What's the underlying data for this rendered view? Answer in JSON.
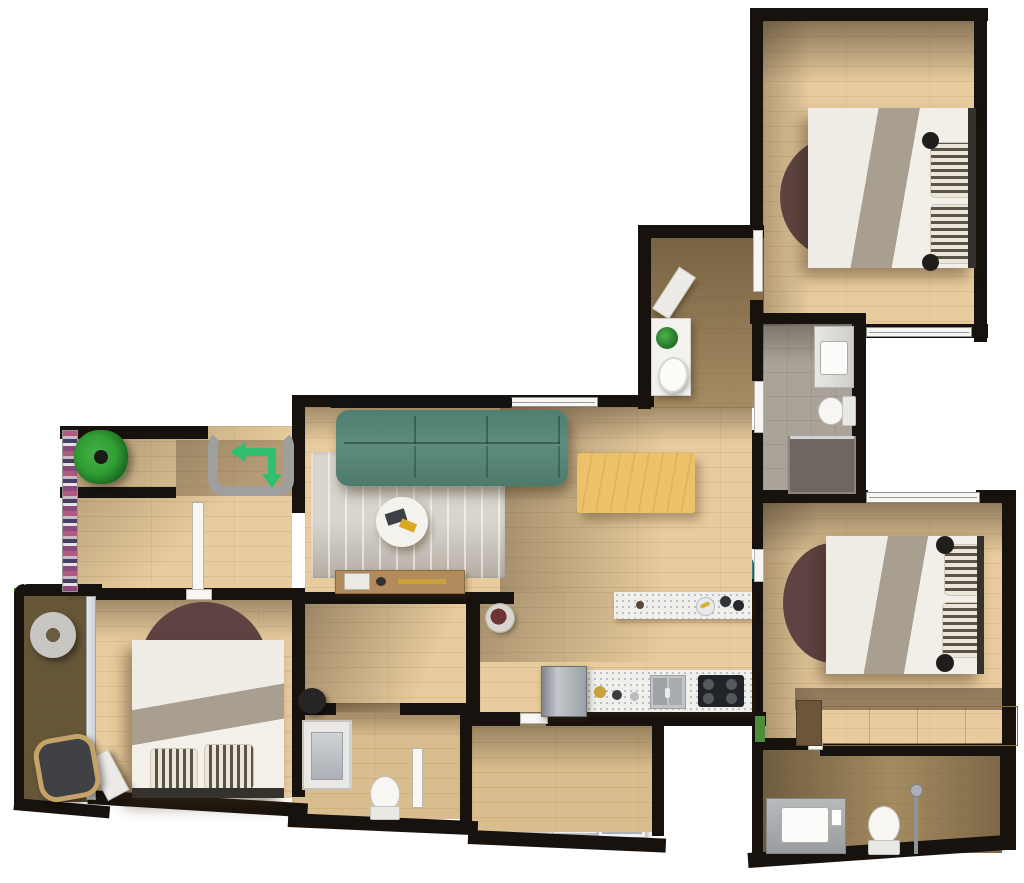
{
  "meta": {
    "title": "3D apartment floor plan — top-down render",
    "view": "top-down",
    "visible_text": "none"
  },
  "palette": {
    "wall": "#17120d",
    "wood": "#e8cc9e",
    "wood_mid": "#d9bd8e",
    "wood_dark": "#b59a6d",
    "balcony_wood": "#9c855c",
    "tile": "#aaa39a",
    "sofa": "#5d8c7e",
    "stool": "#38918d",
    "table": "#ecc169",
    "rug_round": "#5e4342",
    "rug_area": "#d9d5ce",
    "accent_green": "#2fbf71",
    "plant": "#2f9e33",
    "bed_white": "#efece6",
    "blanket": "#a89f91",
    "counter": "#f0efec",
    "chair_seat": "#aab7c1",
    "appliance": "#eff0f2",
    "fixture": "#f7f6f3",
    "headboard": "#35322e",
    "nightstand": "#b5905e",
    "wardrobe": "#c8a26b",
    "fridge": "#9aa0a6",
    "hob": "#202328",
    "grass": "#4c8f3a",
    "glass": "#cdd3d6",
    "bracket": "#9f9f9d",
    "shower_dark": "#6e6660"
  },
  "entry_marker": {
    "icon": "entry-direction-arrows",
    "shape": "rounded bracket with arrow turning left then down",
    "color_ref": "accent_green"
  },
  "rooms": [
    {
      "name": "bedroom-top-right",
      "items": [
        "double-bed",
        "striped-pillows",
        "round-maroon-rug",
        "nightstand-with-candles",
        "window-south"
      ]
    },
    {
      "name": "upper-hallway",
      "items": [
        "diagonal-bench"
      ]
    },
    {
      "name": "bathroom-center",
      "items": [
        "vanity-sink",
        "toilet",
        "walk-in-shower",
        "door"
      ]
    },
    {
      "name": "living-room",
      "items": [
        "wall-tv",
        "teal-sofa",
        "area-rug",
        "round-coffee-table",
        "media-console",
        "window"
      ]
    },
    {
      "name": "dining-area",
      "items": [
        "dining-table",
        "six-chairs",
        "sideboard-with-plant-and-dish"
      ]
    },
    {
      "name": "kitchen",
      "items": [
        "breakfast-bar",
        "three-teal-bar-stools",
        "counter-with-sink",
        "gas-hob",
        "fridge",
        "flower-pot"
      ]
    },
    {
      "name": "entry-hall",
      "items": [
        "entry-arrows-marker",
        "potted-plant",
        "bookshelf-strip",
        "interior-door"
      ]
    },
    {
      "name": "bedroom-left",
      "items": [
        "double-bed",
        "striped-pillows",
        "round-maroon-rug",
        "white-bench",
        "sliding-glass-door"
      ]
    },
    {
      "name": "balcony",
      "items": [
        "round-side-table",
        "rattan-chair"
      ]
    },
    {
      "name": "bathroom-left",
      "items": [
        "shower",
        "toilet",
        "door",
        "black-pouf-outside"
      ]
    },
    {
      "name": "laundry-room",
      "items": [
        "louvered-unit",
        "washer",
        "dryer"
      ]
    },
    {
      "name": "bedroom-mid-right",
      "items": [
        "double-bed",
        "striped-pillows",
        "round-maroon-rug",
        "nightstand-with-candles",
        "window-north",
        "wardrobe-row"
      ]
    },
    {
      "name": "bathroom-ensuite",
      "items": [
        "vanity-sink",
        "toilet",
        "shower-column"
      ]
    }
  ]
}
